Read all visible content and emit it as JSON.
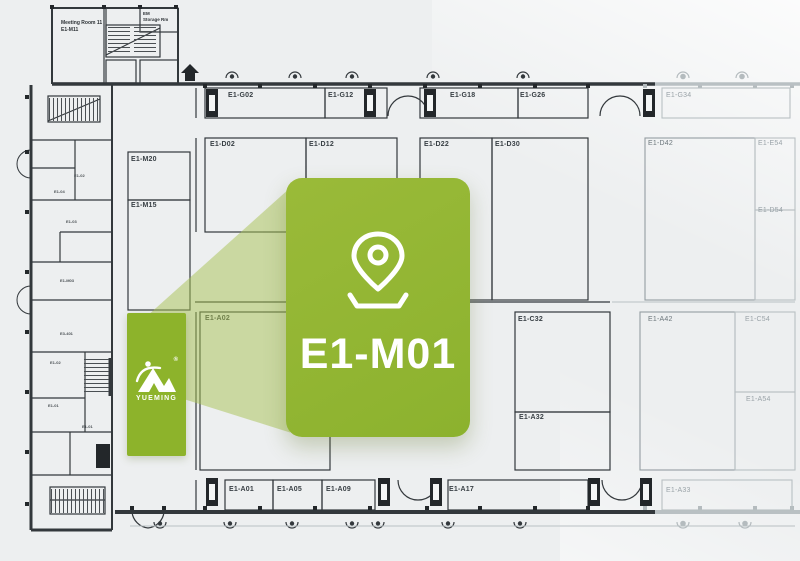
{
  "highlight": {
    "booth_id": "E1-M01",
    "brand": "YUEMING",
    "registered_mark": "®",
    "pin_icon": "location-pin"
  },
  "colors": {
    "highlight_green": "#92b636",
    "beam_green": "#a8c252",
    "plan_ink": "#33383c",
    "plan_faded": "#b9c0c3",
    "background": "#edeff0"
  },
  "complex": {
    "meeting_room_name": "Meeting Room 11",
    "meeting_room_id": "E1-M11",
    "storage_line1": "EM",
    "storage_line2": "Storage Rm"
  },
  "booths": [
    {
      "label": "E1-G02"
    },
    {
      "label": "E1-G12"
    },
    {
      "label": "E1-G18"
    },
    {
      "label": "E1-G26"
    },
    {
      "label": "E1-G34"
    },
    {
      "label": "E1-D02"
    },
    {
      "label": "E1-D12"
    },
    {
      "label": "E1-D22"
    },
    {
      "label": "E1-D30"
    },
    {
      "label": "E1-D42"
    },
    {
      "label": "E1-E54"
    },
    {
      "label": "E1-D54"
    },
    {
      "label": "E1-M20"
    },
    {
      "label": "E1-M15"
    },
    {
      "label": "E1-A02"
    },
    {
      "label": "E1-C32"
    },
    {
      "label": "E1-A32"
    },
    {
      "label": "E1-A42"
    },
    {
      "label": "E1-C54"
    },
    {
      "label": "E1-A54"
    },
    {
      "label": "E1-A01"
    },
    {
      "label": "E1-A05"
    },
    {
      "label": "E1-A09"
    },
    {
      "label": "E1-A17"
    },
    {
      "label": "E1-A33"
    }
  ],
  "wing_rooms": [
    {
      "label": "E1-02"
    },
    {
      "label": "E1-04"
    },
    {
      "label": "E1-03"
    },
    {
      "label": "E1-M03"
    },
    {
      "label": "E3-401"
    },
    {
      "label": "E1-02"
    },
    {
      "label": "E1-01"
    },
    {
      "label": "E1-01"
    }
  ]
}
